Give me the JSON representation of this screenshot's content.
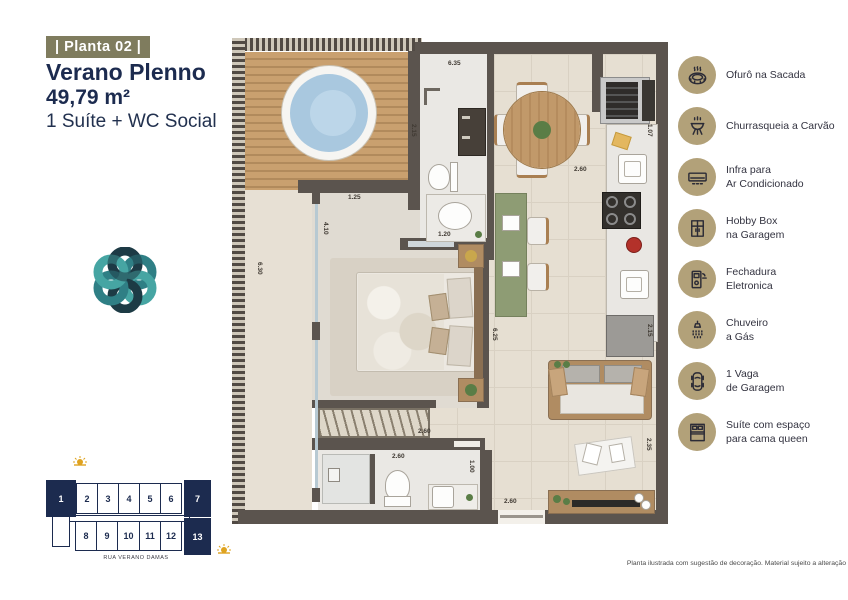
{
  "header": {
    "badge": "| Planta 02 |",
    "title": "Verano Plenno",
    "area": "49,79 m²",
    "subtitle": "1 Suíte + WC Social"
  },
  "amenities": [
    {
      "icon": "hot-tub-icon",
      "label": "Ofurô na Sacada"
    },
    {
      "icon": "charcoal-grill-icon",
      "label": "Churrasqueia a Carvão"
    },
    {
      "icon": "air-conditioner-icon",
      "label": "Infra para\nAr Condicionado"
    },
    {
      "icon": "hobby-box-icon",
      "label": "Hobby Box\nna Garagem"
    },
    {
      "icon": "electronic-lock-icon",
      "label": "Fechadura\nEletronica"
    },
    {
      "icon": "gas-shower-icon",
      "label": "Chuveiro\na Gás"
    },
    {
      "icon": "parking-car-icon",
      "label": "1 Vaga\nde Garagem"
    },
    {
      "icon": "queen-bed-icon",
      "label": "Suíte com espaço\npara cama queen"
    }
  ],
  "plan": {
    "dims": [
      "6.35",
      "2.15",
      "1.07",
      "2.60",
      "1.25",
      "1.20",
      "4.10",
      "6.30",
      "6.25",
      "2.15",
      "2.60",
      "2.60",
      "1.00",
      "2.60",
      "2.35"
    ]
  },
  "building": {
    "units": [
      "1",
      "2",
      "3",
      "4",
      "5",
      "6",
      "7",
      "8",
      "9",
      "10",
      "11",
      "12",
      "13"
    ],
    "street": "RUA VERANO DAMAS"
  },
  "footer": {
    "disclaimer": "Planta ilustrada com sugestão de decoração. Material sujeito a alteração"
  },
  "colors": {
    "navy": "#1c2b4f",
    "olive": "#7f7c5e",
    "tan": "#b2a179",
    "teal": "#2f7f85",
    "gold": "#dfa320"
  }
}
